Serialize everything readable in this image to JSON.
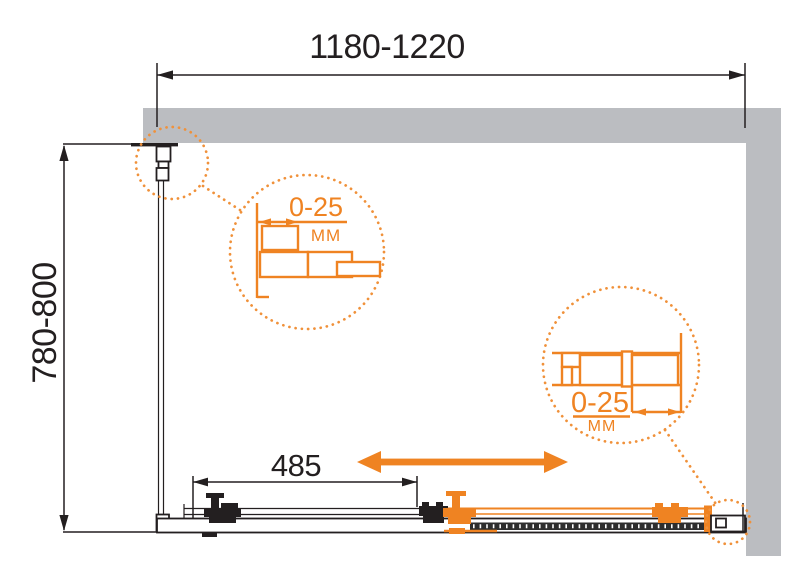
{
  "diagram": {
    "title": "shower-enclosure-installation-plan",
    "dimensions": {
      "width": {
        "label": "1180-1220"
      },
      "depth": {
        "label": "780-800"
      },
      "door_opening": {
        "label": "485"
      }
    },
    "details": [
      {
        "adjustment": "0-25",
        "unit": "MM",
        "position": "left-wall-profile"
      },
      {
        "adjustment": "0-25",
        "unit": "MM",
        "position": "right-wall-profile"
      }
    ],
    "colors": {
      "accent_orange": "#ef8322",
      "wall_gray": "#bbbdc1",
      "line_black": "#231f20",
      "background": "#ffffff"
    }
  }
}
